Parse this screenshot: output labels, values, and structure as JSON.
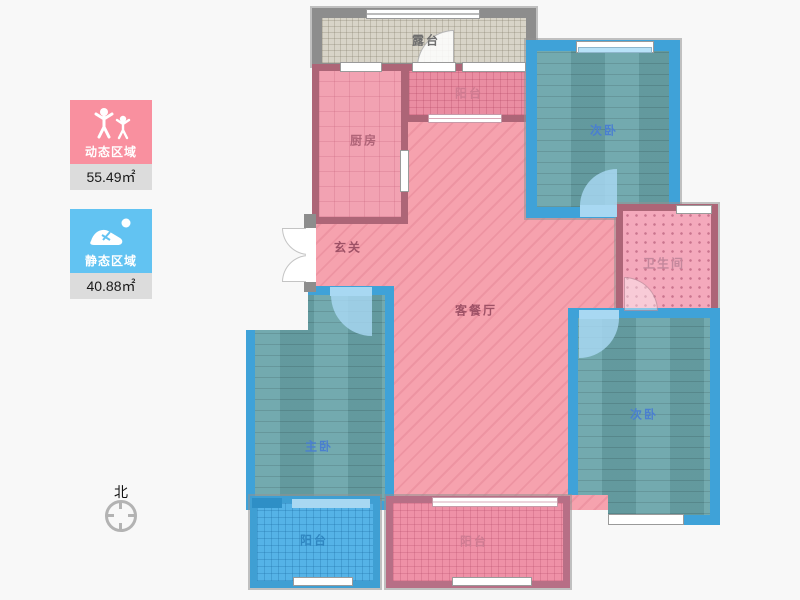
{
  "page": {
    "background": "#f8f8f8"
  },
  "legend": {
    "dynamic": {
      "label": "动态区域",
      "value": "55.49㎡",
      "color": "#f9909f",
      "icon": "people-icon"
    },
    "static": {
      "label": "静态区域",
      "value": "40.88㎡",
      "color": "#62c3f2",
      "icon": "sleeping-person-icon"
    }
  },
  "compass": {
    "north_label": "北"
  },
  "colors": {
    "dynamic_floor": "#f6a2ae",
    "dynamic_wall": "#ad6577",
    "static_floor": "#6aa5aa",
    "static_wall": "#3fa2d8",
    "terrace_floor": "#d8d4c8",
    "terrace_wall": "#8d8d8d"
  },
  "rooms": {
    "terrace": {
      "label": "露台"
    },
    "kitchen": {
      "label": "厨房"
    },
    "balcony_top": {
      "label": "阳台"
    },
    "bedroom_top_right": {
      "label": "次卧"
    },
    "hallway": {
      "label": "玄关"
    },
    "living_dining": {
      "label": "客餐厅"
    },
    "bathroom": {
      "label": "卫生间"
    },
    "master_bedroom": {
      "label": "主卧"
    },
    "bedroom_bottom_right": {
      "label": "次卧"
    },
    "balcony_bottom_left": {
      "label": "阳台"
    },
    "balcony_bottom_middle": {
      "label": "阳台"
    }
  }
}
